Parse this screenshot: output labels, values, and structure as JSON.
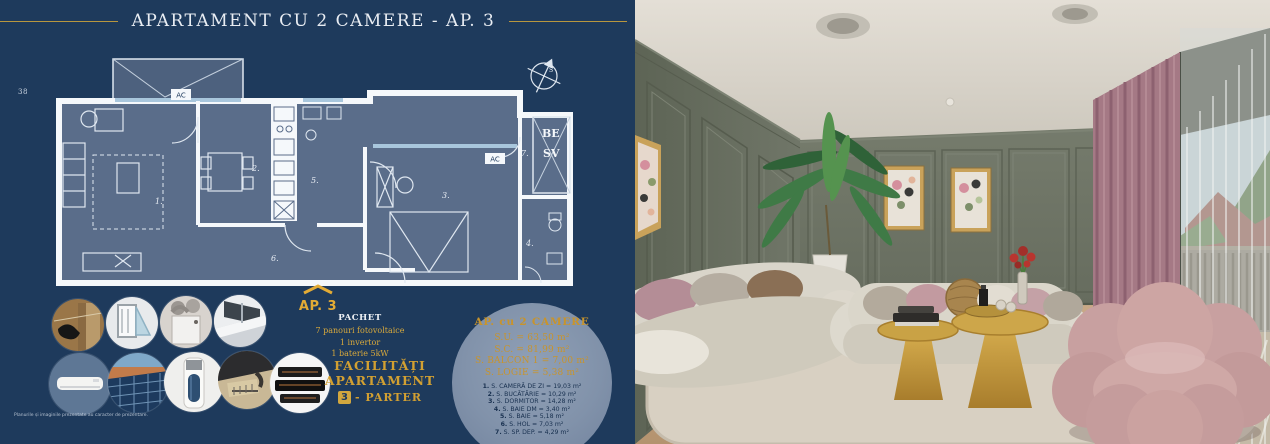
{
  "page": {
    "title": "APARTAMENT CU 2 CAMERE  -  AP. 3",
    "page_number": "38",
    "disclaimer": "Planurile și imaginile prezentate au caracter de prezentare."
  },
  "floorplan": {
    "marker": "AP. 3",
    "ac_label": "AC",
    "compass_label": "S",
    "shaft_label_1": "BE",
    "shaft_label_2": "SV",
    "room_labels": [
      "1.",
      "2.",
      "3.",
      "4.",
      "5.",
      "6.",
      "7."
    ]
  },
  "package": {
    "heading": "PACHET",
    "items": [
      "7 panouri fotovoltaice",
      "1 invertor",
      "1 baterie 5kW"
    ]
  },
  "facilities": {
    "line1": "FACILITĂȚI",
    "line2": "APARTAMENT",
    "floor_badge": "3",
    "floor_label": "- PARTER"
  },
  "icon_circles": [
    "thermal-insulation-photo",
    "pvc-window-profile-photo",
    "ventilation-unit-photo",
    "modern-balcony-photo",
    "air-conditioner-photo",
    "solar-panels-photo",
    "heat-pump-boiler-photo",
    "technical-drawing-photo",
    "heating-film-photo"
  ],
  "details": {
    "heading": "AP. cu 2 CAMERE",
    "areas": [
      "S.U. = 63,50 m²",
      "S.C. = 81,99 m²",
      "S. BALCON 1 = 7,00 m²",
      "S. LOGIE = 5,38 m²"
    ],
    "rooms": [
      {
        "num": "1.",
        "text": " S. CAMERĂ DE ZI = 19,03 m²"
      },
      {
        "num": "2.",
        "text": " S. BUCĂTĂRIE = 10,29 m²"
      },
      {
        "num": "3.",
        "text": " S. DORMITOR = 14,28 m²"
      },
      {
        "num": "4.",
        "text": " S. BAIE DM = 3,40 m²"
      },
      {
        "num": "5.",
        "text": " S. BAIE = 5,18 m²"
      },
      {
        "num": "6.",
        "text": " S. HOL = 7,03 m²"
      },
      {
        "num": "7.",
        "text": " S. SP. DEP. = 4,29 m²"
      }
    ]
  },
  "colors": {
    "navy": "#1e3a5c",
    "gold": "#d2a73e",
    "plan_slate": "#5a6d8a",
    "wall_green": "#6f7566",
    "curtain_pink": "#a57985",
    "sofa_cream": "#d9d5ca",
    "table_gold": "#c9a245",
    "chair_pink": "#c8a0a0"
  }
}
